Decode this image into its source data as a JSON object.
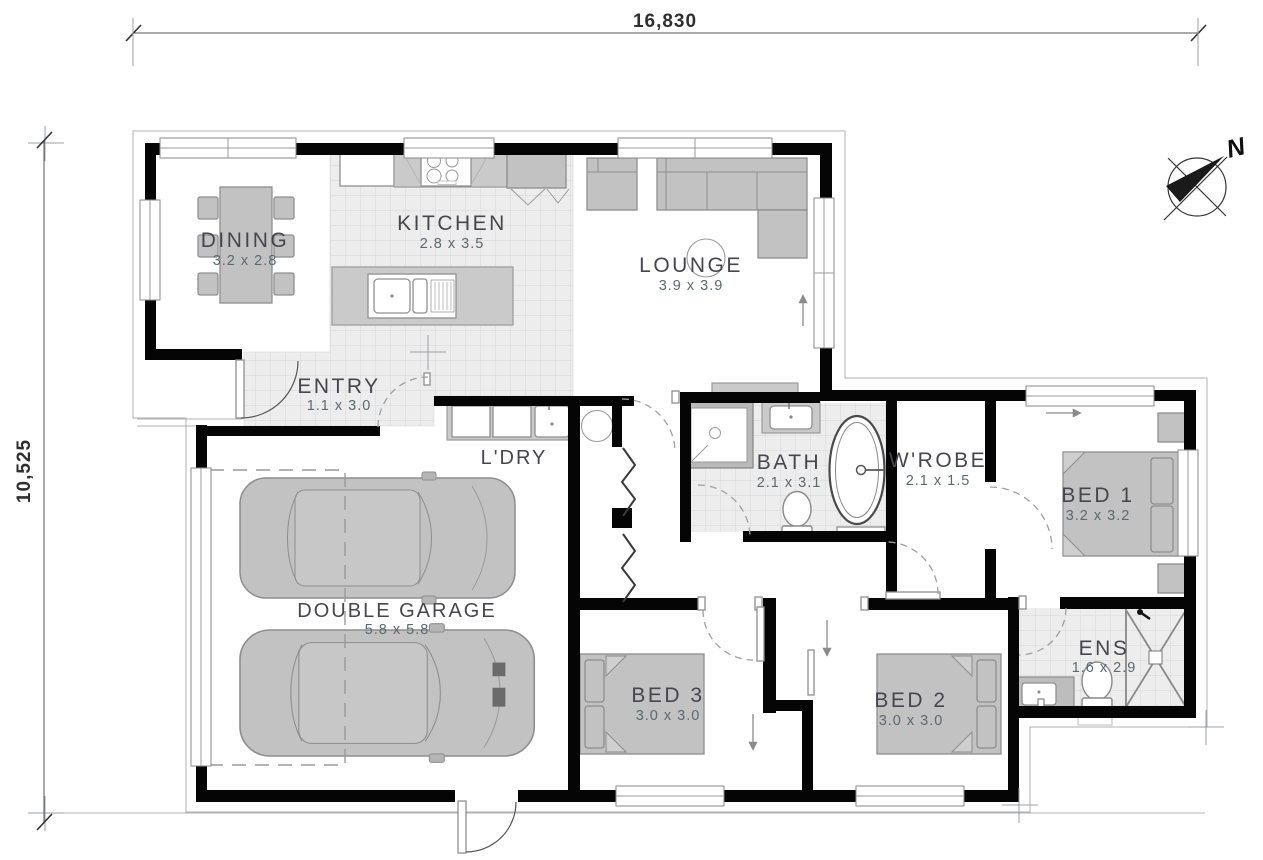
{
  "dimensions": {
    "top": "16,830",
    "left": "10,525"
  },
  "compass": {
    "north_label": "N"
  },
  "rooms": [
    {
      "id": "dining",
      "name": "DINING",
      "dims": "3.2 x 2.8"
    },
    {
      "id": "kitchen",
      "name": "KITCHEN",
      "dims": "2.8 x 3.5"
    },
    {
      "id": "lounge",
      "name": "LOUNGE",
      "dims": "3.9 x 3.9"
    },
    {
      "id": "entry",
      "name": "ENTRY",
      "dims": "1.1 x 3.0"
    },
    {
      "id": "ldry",
      "name": "L'DRY",
      "dims": ""
    },
    {
      "id": "bath",
      "name": "BATH",
      "dims": "2.1 x 3.1"
    },
    {
      "id": "wrobe",
      "name": "W'ROBE",
      "dims": "2.1 x 1.5"
    },
    {
      "id": "bed1",
      "name": "BED 1",
      "dims": "3.2 x 3.2"
    },
    {
      "id": "garage",
      "name": "DOUBLE GARAGE",
      "dims": "5.8 x 5.8"
    },
    {
      "id": "bed3",
      "name": "BED 3",
      "dims": "3.0 x 3.0"
    },
    {
      "id": "bed2",
      "name": "BED 2",
      "dims": "3.0 x 3.0"
    },
    {
      "id": "ens",
      "name": "ENS",
      "dims": "1.6 x 2.9"
    }
  ],
  "colors": {
    "wall": "#050505",
    "floor_tile": "#ededed",
    "furniture": "#c2c2c2",
    "room_label": "#46464e",
    "dims_label": "#5b6970"
  }
}
